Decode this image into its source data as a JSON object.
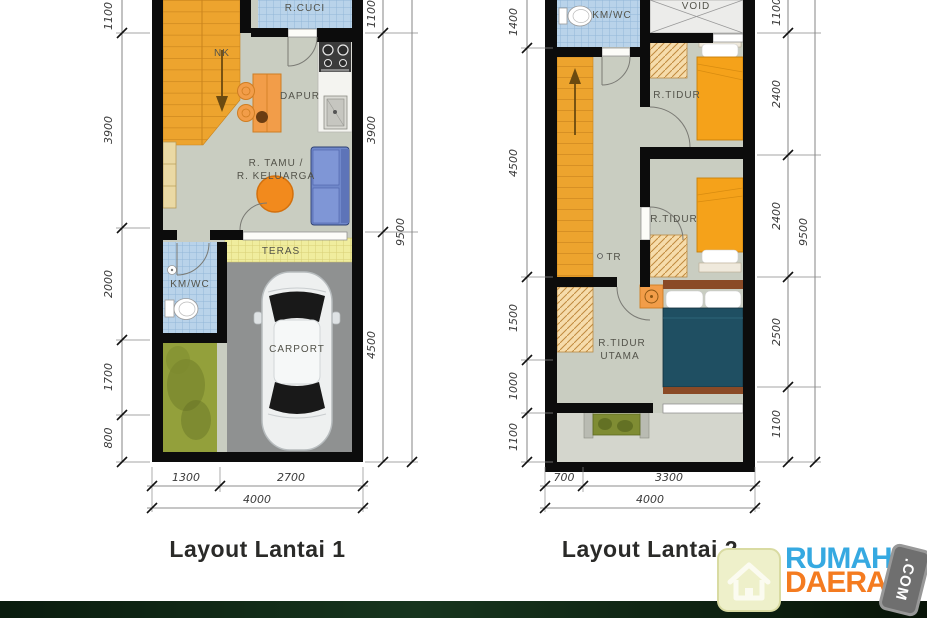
{
  "floor1": {
    "title": "Layout Lantai 1",
    "labels": {
      "laundry": "R.CUCI",
      "nk": "NK",
      "kitchen": "DAPUR",
      "living_line1": "R. TAMU /",
      "living_line2": "R. KELUARGA",
      "terrace": "TERAS",
      "bathroom": "KM/WC",
      "carport": "CARPORT"
    },
    "dims": {
      "left": [
        "1100",
        "3900",
        "2000",
        "1700",
        "800"
      ],
      "right": [
        "1100",
        "3900",
        "4500"
      ],
      "right_total": "9500",
      "bottom": [
        "1300",
        "2700"
      ],
      "bottom_total": "4000"
    }
  },
  "floor2": {
    "title": "Layout Lantai 2",
    "labels": {
      "bathroom": "KM/WC",
      "void": "VOID",
      "bedroom1": "R.TIDUR",
      "bedroom2": "R.TIDUR",
      "stair_note": "TR",
      "master_line1": "R.TIDUR",
      "master_line2": "UTAMA"
    },
    "dims": {
      "left": [
        "1400",
        "4500",
        "1500",
        "1000",
        "1100"
      ],
      "right": [
        "1100",
        "2400",
        "2400",
        "2500",
        "1100"
      ],
      "right_total": "9500",
      "bottom": [
        "700",
        "3300"
      ],
      "bottom_total": "4000"
    }
  },
  "logo": {
    "brand_line1": "RUMAH",
    "brand_line2": "DAERAH",
    "badge": ".COM"
  },
  "colors": {
    "wall": "#0c0c0c",
    "floor": "#c9cdc1",
    "stairs": "#eda42e",
    "tile_blue": "#b9d3ea",
    "terrace_yellow": "#f0ed9e",
    "garden": "#93a03b",
    "carport": "#8f9191",
    "sofa": "#7088ca",
    "bed_orange": "#f5a21a",
    "master_bed": "#1f4f62",
    "brand_blue": "#36a9e1",
    "brand_orange": "#f47b20",
    "footer_green": "#0d2413"
  }
}
